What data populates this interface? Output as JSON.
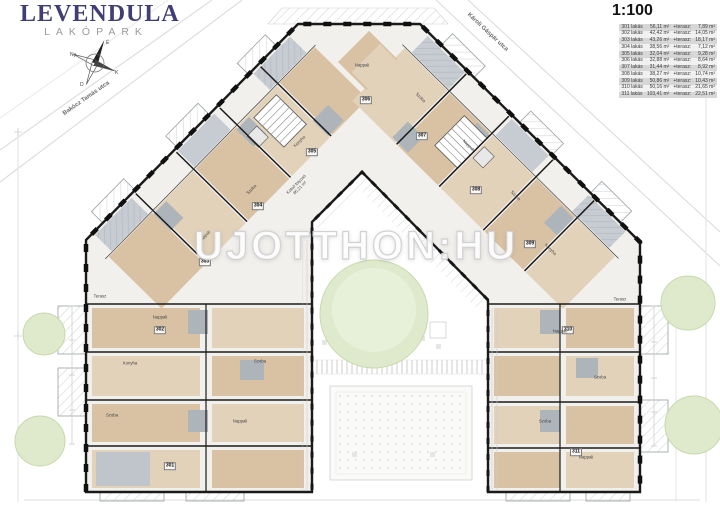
{
  "logo": {
    "title": "LEVENDULA",
    "subtitle": "LAKÓPARK"
  },
  "scale_label": "1:100",
  "streets": {
    "top_left": "Bakócz Tamás utca",
    "top_right": "Károli Gáspár utca"
  },
  "watermark": "UJOTTHON:HU",
  "compass": {
    "north": "É",
    "south": "D",
    "east": "K",
    "west": "Ny"
  },
  "apartments_table": {
    "rows": [
      {
        "unit": "301 lakás",
        "area": "56,11 m²",
        "plus": "+terasz:",
        "terrace": "7,89 m²"
      },
      {
        "unit": "302 lakás",
        "area": "42,42 m²",
        "plus": "+terasz:",
        "terrace": "14,05 m²"
      },
      {
        "unit": "303 lakás",
        "area": "43,26 m²",
        "plus": "+terasz:",
        "terrace": "18,17 m²"
      },
      {
        "unit": "304 lakás",
        "area": "38,56 m²",
        "plus": "+terasz:",
        "terrace": "7,12 m²"
      },
      {
        "unit": "305 lakás",
        "area": "32,04 m²",
        "plus": "+terasz:",
        "terrace": "9,28 m²"
      },
      {
        "unit": "306 lakás",
        "area": "32,88 m²",
        "plus": "+terasz:",
        "terrace": "8,64 m²"
      },
      {
        "unit": "307 lakás",
        "area": "31,44 m²",
        "plus": "+terasz:",
        "terrace": "8,92 m²"
      },
      {
        "unit": "308 lakás",
        "area": "38,27 m²",
        "plus": "+terasz:",
        "terrace": "10,74 m²"
      },
      {
        "unit": "309 lakás",
        "area": "50,86 m²",
        "plus": "+terasz:",
        "terrace": "10,43 m²"
      },
      {
        "unit": "310 lakás",
        "area": "50,16 m²",
        "plus": "+terasz:",
        "terrace": "21,65 m²"
      },
      {
        "unit": "311 lakás",
        "area": "103,41 m²",
        "plus": "+terasz:",
        "terrace": "22,51 m²"
      }
    ]
  },
  "plan": {
    "corridor_label": {
      "text": "Külső folyosó",
      "area": "86,21 m²"
    },
    "unit_markers": [
      {
        "n": "301",
        "x": 170,
        "y": 466
      },
      {
        "n": "302",
        "x": 160,
        "y": 330
      },
      {
        "n": "303",
        "x": 205,
        "y": 262
      },
      {
        "n": "304",
        "x": 258,
        "y": 206
      },
      {
        "n": "305",
        "x": 312,
        "y": 152
      },
      {
        "n": "306",
        "x": 366,
        "y": 100
      },
      {
        "n": "307",
        "x": 422,
        "y": 136
      },
      {
        "n": "308",
        "x": 476,
        "y": 190
      },
      {
        "n": "309",
        "x": 530,
        "y": 244
      },
      {
        "n": "310",
        "x": 568,
        "y": 330
      },
      {
        "n": "311",
        "x": 576,
        "y": 452
      }
    ],
    "room_labels": [
      {
        "text": "Nappali",
        "x": 160,
        "y": 318,
        "rot": 0
      },
      {
        "text": "Konyha",
        "x": 130,
        "y": 364,
        "rot": 0
      },
      {
        "text": "Szoba",
        "x": 112,
        "y": 416,
        "rot": 0
      },
      {
        "text": "Nappali",
        "x": 240,
        "y": 422,
        "rot": 0
      },
      {
        "text": "Szoba",
        "x": 260,
        "y": 362,
        "rot": 0
      },
      {
        "text": "Terasz",
        "x": 100,
        "y": 297,
        "rot": 0
      },
      {
        "text": "Nappali",
        "x": 205,
        "y": 237,
        "rot": -45
      },
      {
        "text": "Szoba",
        "x": 252,
        "y": 190,
        "rot": -45
      },
      {
        "text": "Konyha",
        "x": 300,
        "y": 142,
        "rot": -45
      },
      {
        "text": "Nappali",
        "x": 362,
        "y": 66,
        "rot": 0
      },
      {
        "text": "Szoba",
        "x": 420,
        "y": 98,
        "rot": 45
      },
      {
        "text": "Nappali",
        "x": 468,
        "y": 146,
        "rot": 45
      },
      {
        "text": "Szoba",
        "x": 515,
        "y": 196,
        "rot": 45
      },
      {
        "text": "Konyha",
        "x": 550,
        "y": 250,
        "rot": 45
      },
      {
        "text": "Nappali",
        "x": 560,
        "y": 332,
        "rot": 0
      },
      {
        "text": "Szoba",
        "x": 600,
        "y": 378,
        "rot": 0
      },
      {
        "text": "Szoba",
        "x": 545,
        "y": 422,
        "rot": 0
      },
      {
        "text": "Nappali",
        "x": 586,
        "y": 458,
        "rot": 0
      },
      {
        "text": "Terasz",
        "x": 620,
        "y": 300,
        "rot": 0
      }
    ]
  }
}
